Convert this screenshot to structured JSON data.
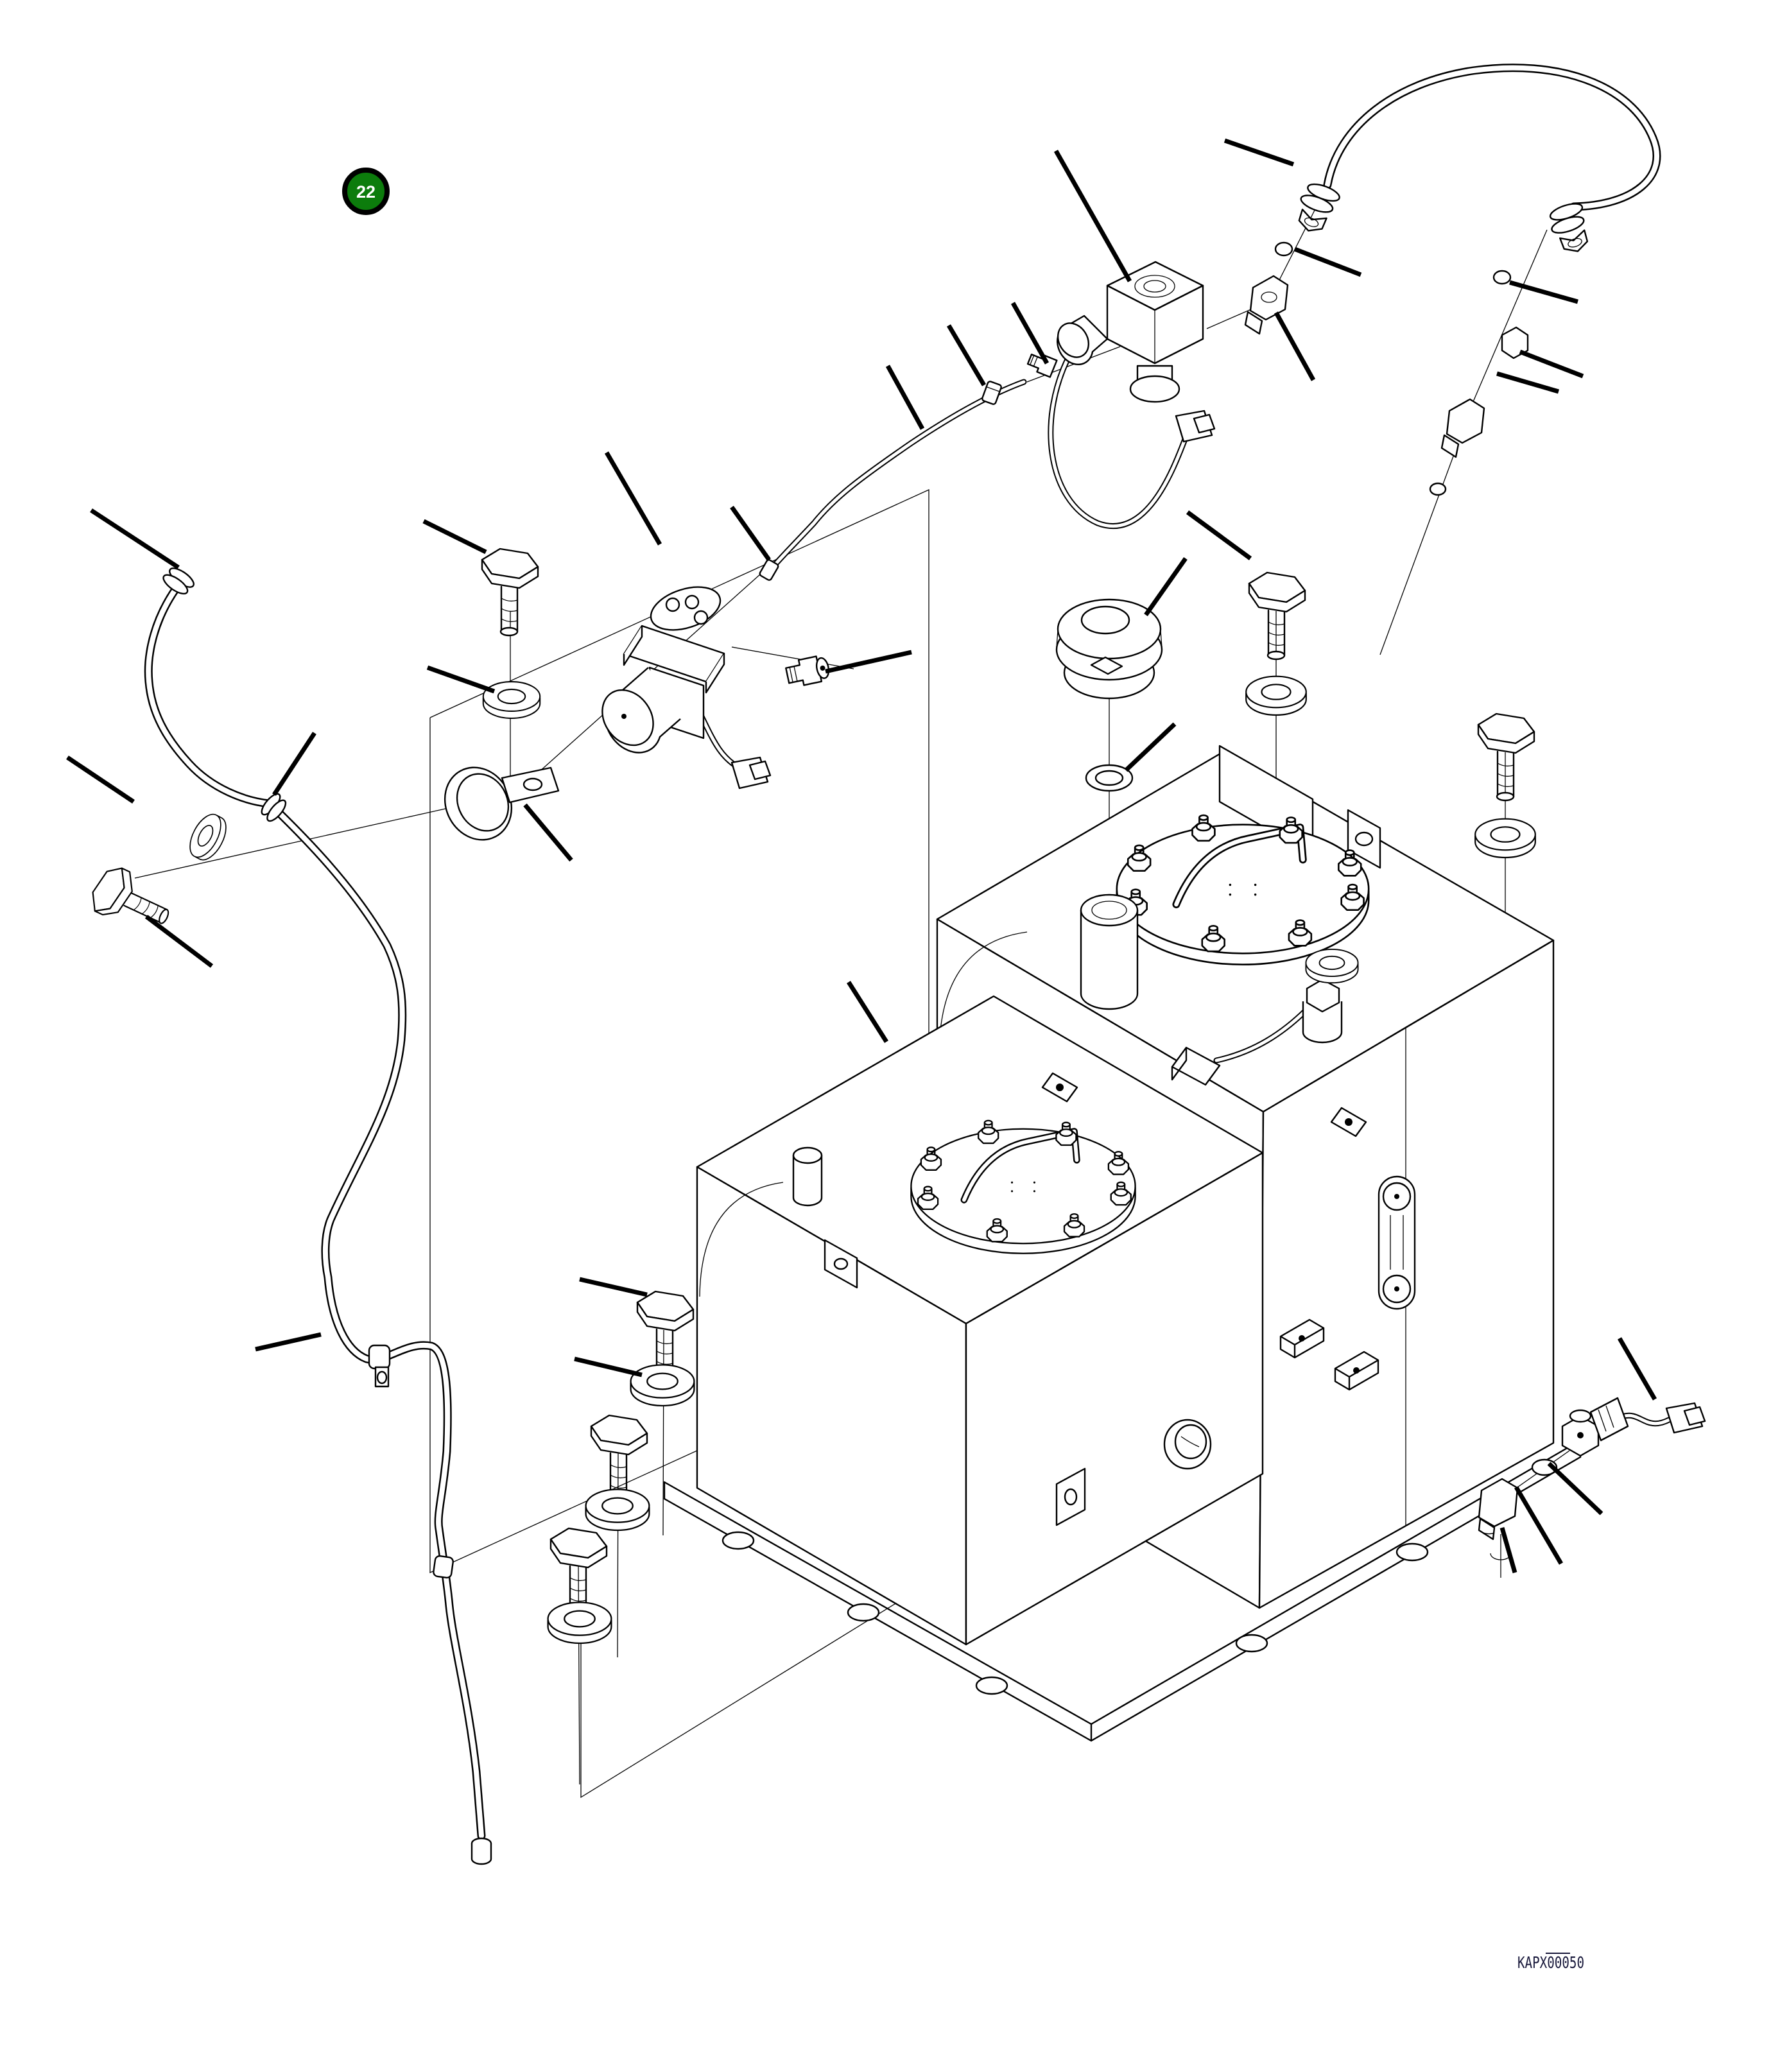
{
  "figure": {
    "badge": {
      "number": "22",
      "color": "#0c7c0c",
      "ring_color": "#000000"
    },
    "drawing_code": "KAPX00050",
    "colors": {
      "line": "#000000",
      "background": "#ffffff",
      "code_text": "#17173a"
    }
  }
}
